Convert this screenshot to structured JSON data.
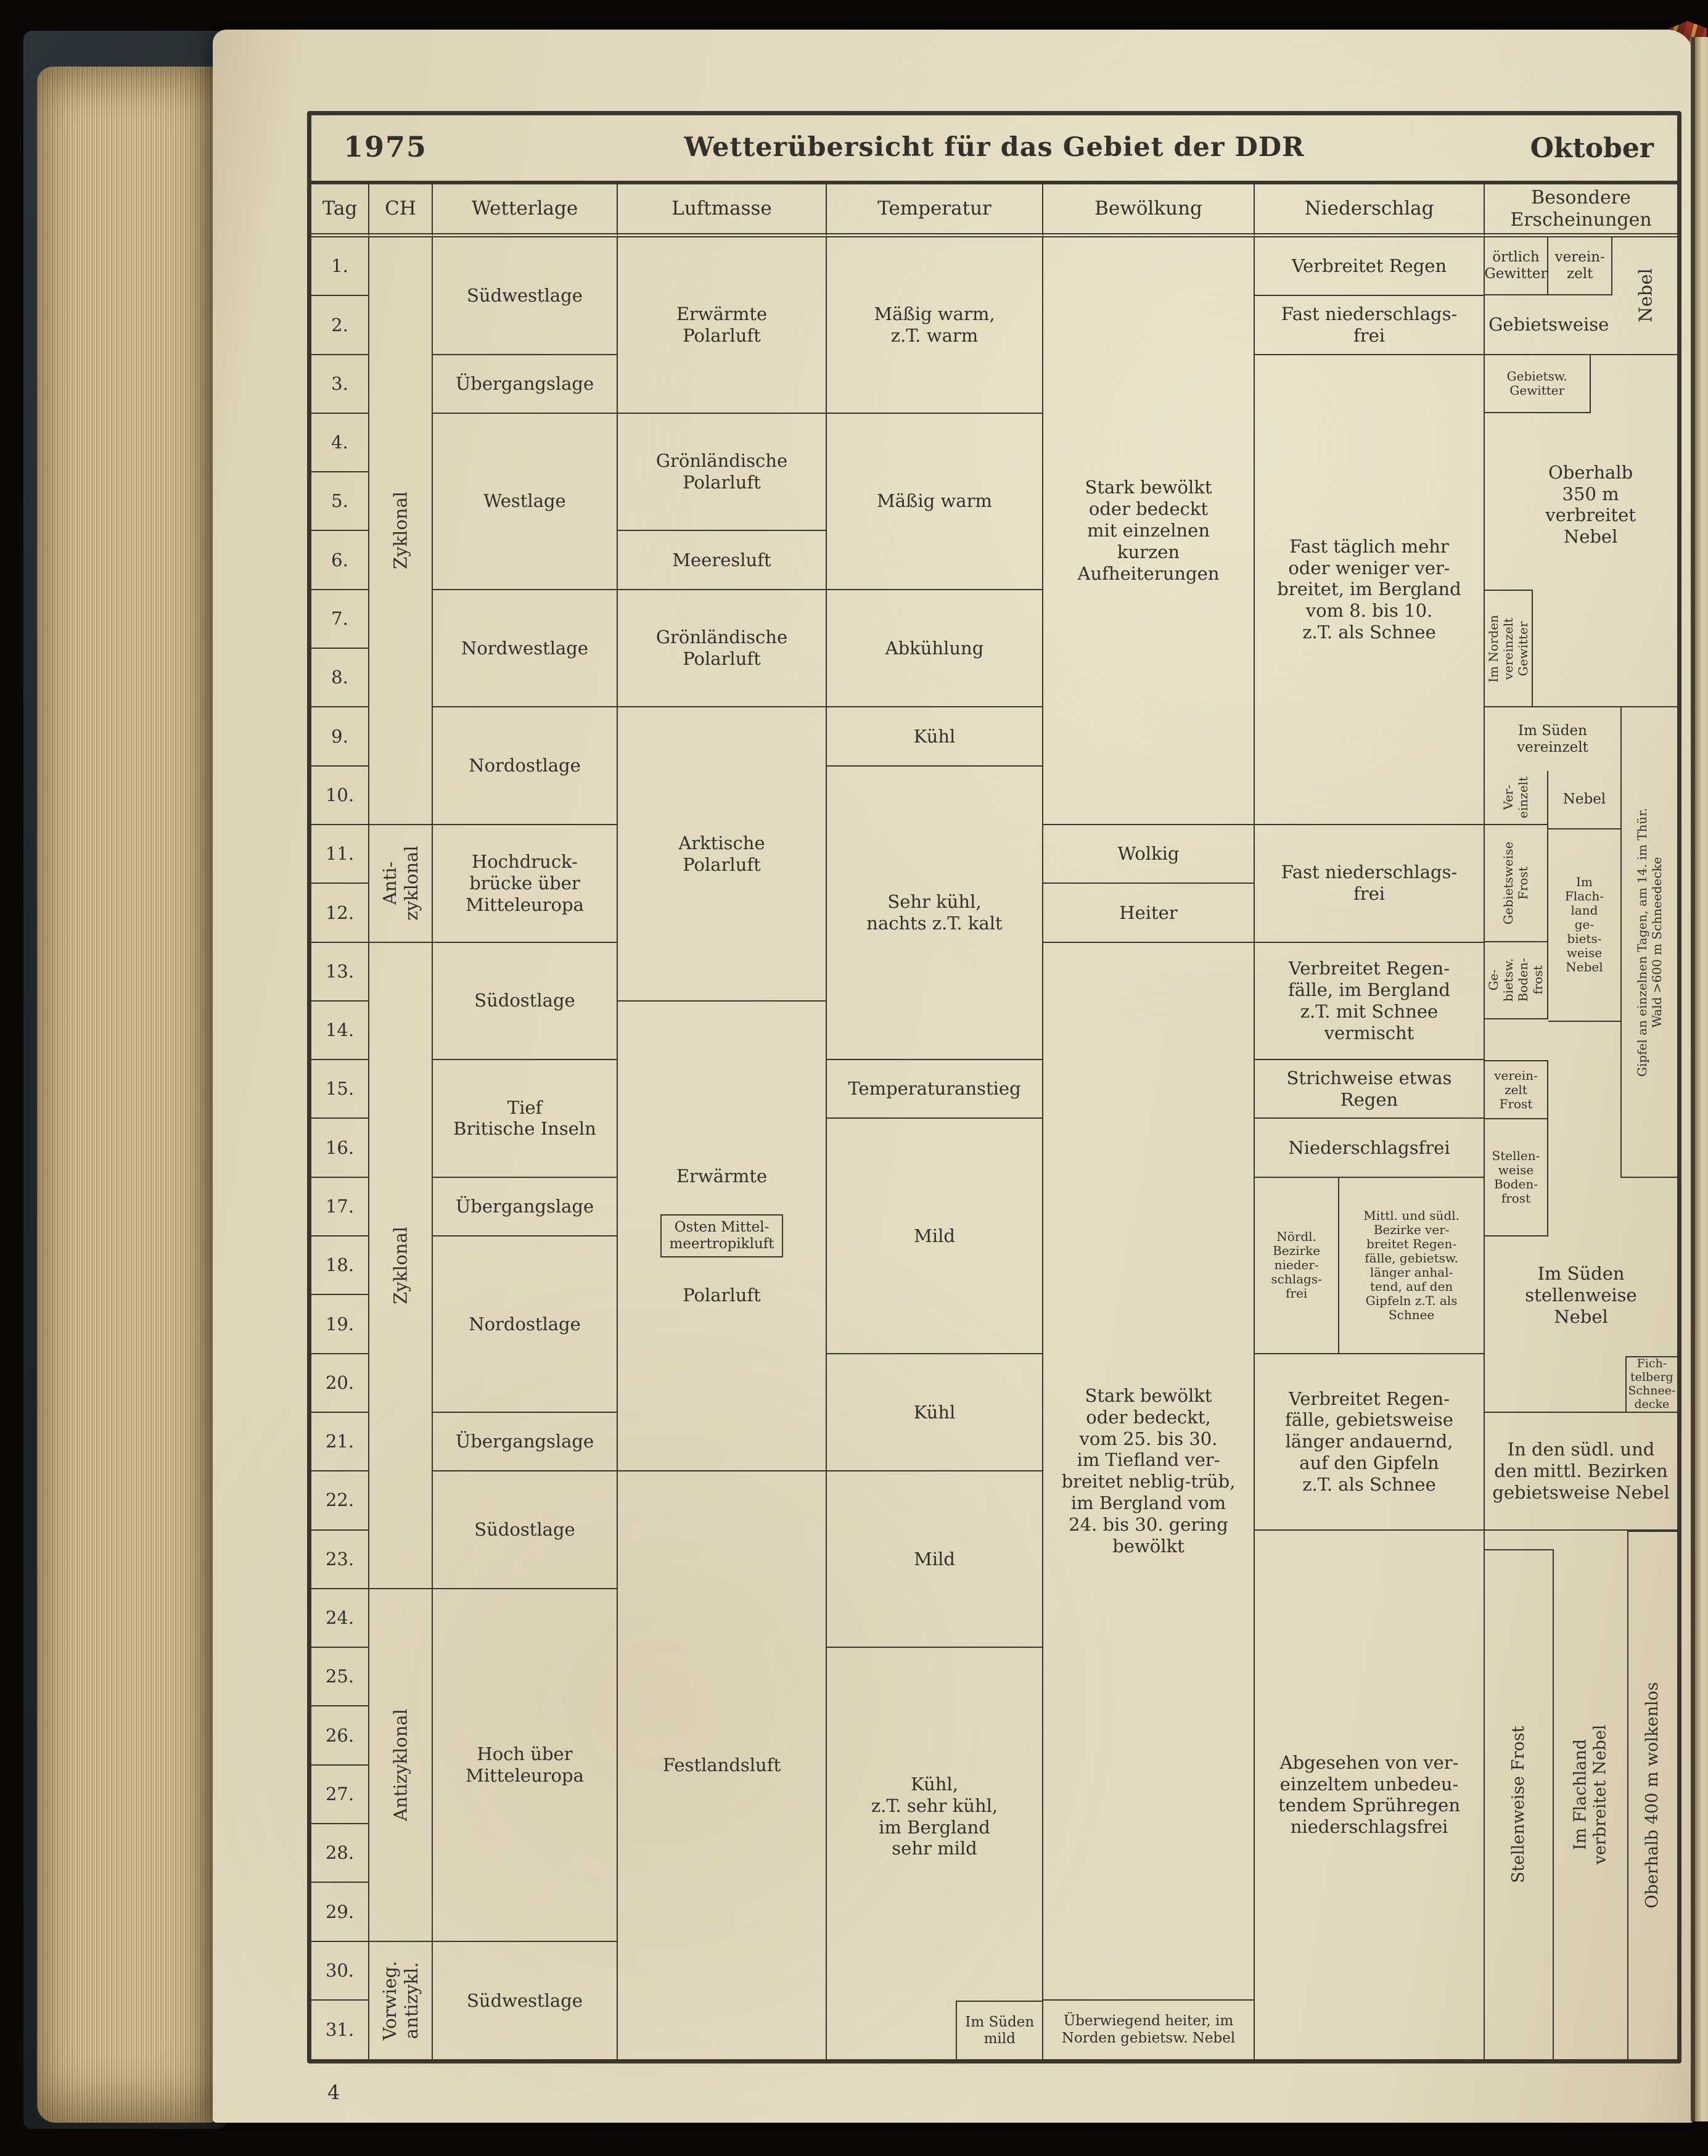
{
  "page": {
    "year": "1975",
    "title": "Wetterübersicht für das Gebiet der DDR",
    "month": "Oktober",
    "page_number": "4"
  },
  "header": {
    "tag": "Tag",
    "ch": "CH",
    "wetterlage": "Wetterlage",
    "luftmasse": "Luftmasse",
    "temperatur": "Temperatur",
    "bewoelkung": "Bewölkung",
    "niederschlag": "Niederschlag",
    "besondere": "Besondere\nErscheinungen"
  },
  "days": [
    "1.",
    "2.",
    "3.",
    "4.",
    "5.",
    "6.",
    "7.",
    "8.",
    "9.",
    "10.",
    "11.",
    "12.",
    "13.",
    "14.",
    "15.",
    "16.",
    "17.",
    "18.",
    "19.",
    "20.",
    "21.",
    "22.",
    "23.",
    "24.",
    "25.",
    "26.",
    "27.",
    "28.",
    "29.",
    "30.",
    "31."
  ],
  "ch": [
    {
      "rows": "1-10",
      "text": "Zyklonal"
    },
    {
      "rows": "11-12",
      "text": "Anti-\nzyklonal"
    },
    {
      "rows": "13-23",
      "text": "Zyklonal"
    },
    {
      "rows": "24-29",
      "text": "Antizyklonal"
    },
    {
      "rows": "30-31",
      "text": "Vorwieg.\nantizykl."
    }
  ],
  "wetterlage": [
    {
      "rows": "1-2",
      "text": "Südwestlage"
    },
    {
      "rows": "3",
      "text": "Übergangslage"
    },
    {
      "rows": "4-6",
      "text": "Westlage"
    },
    {
      "rows": "7-8",
      "text": "Nordwestlage"
    },
    {
      "rows": "9-10",
      "text": "Nordostlage"
    },
    {
      "rows": "11-12",
      "text": "Hochdruck-\nbrücke über\nMitteleuropa"
    },
    {
      "rows": "13-14",
      "text": "Südostlage"
    },
    {
      "rows": "15-16",
      "text": "Tief\nBritische Inseln"
    },
    {
      "rows": "17",
      "text": "Übergangslage"
    },
    {
      "rows": "18-20",
      "text": "Nordostlage"
    },
    {
      "rows": "21",
      "text": "Übergangslage"
    },
    {
      "rows": "22-23",
      "text": "Südostlage"
    },
    {
      "rows": "24-29",
      "text": "Hoch über\nMitteleuropa"
    },
    {
      "rows": "30-31",
      "text": "Südwestlage"
    }
  ],
  "luftmasse": [
    {
      "rows": "1-3",
      "text": "Erwärmte\nPolarluft"
    },
    {
      "rows": "4-5",
      "text": "Grönländische\nPolarluft"
    },
    {
      "rows": "6",
      "text": "Meeresluft"
    },
    {
      "rows": "7-8",
      "text": "Grönländische\nPolarluft"
    },
    {
      "rows": "9-13",
      "text": "Arktische\nPolarluft"
    },
    {
      "rows": "14-21",
      "text": "Erwärmte"
    },
    {
      "rows": "18",
      "text": "Osten Mittel-\nmeertropikluft"
    },
    {
      "rows": "14-21",
      "text": "Polarluft"
    },
    {
      "rows": "22-31",
      "text": "Festlandsluft"
    }
  ],
  "temperatur": [
    {
      "rows": "1-3",
      "text": "Mäßig warm,\nz.T. warm"
    },
    {
      "rows": "4-6",
      "text": "Mäßig warm"
    },
    {
      "rows": "7-8",
      "text": "Abkühlung"
    },
    {
      "rows": "9",
      "text": "Kühl"
    },
    {
      "rows": "10-14",
      "text": "Sehr kühl,\nnachts z.T. kalt"
    },
    {
      "rows": "15",
      "text": "Temperaturanstieg"
    },
    {
      "rows": "16-19",
      "text": "Mild"
    },
    {
      "rows": "20-21",
      "text": "Kühl"
    },
    {
      "rows": "22-24",
      "text": "Mild"
    },
    {
      "rows": "25-31",
      "text": "Kühl,\nz.T. sehr kühl,\nim Bergland\nsehr mild"
    },
    {
      "rows": "31",
      "text": "Im Süden\nmild"
    }
  ],
  "bewoelkung": [
    {
      "rows": "1-10",
      "text": "Stark bewölkt\noder bedeckt\nmit einzelnen\nkurzen\nAufheiterungen"
    },
    {
      "rows": "11",
      "text": "Wolkig"
    },
    {
      "rows": "12",
      "text": "Heiter"
    },
    {
      "rows": "13-30",
      "text": "Stark bewölkt\noder bedeckt,\nvom 25. bis 30.\nim Tiefland ver-\nbreitet neblig-trüb,\nim Bergland vom\n24. bis 30. gering\nbewölkt"
    },
    {
      "rows": "31",
      "text": "Überwiegend heiter, im\nNorden gebietsw. Nebel"
    }
  ],
  "niederschlag": [
    {
      "rows": "1",
      "text": "Verbreitet Regen"
    },
    {
      "rows": "2",
      "text": "Fast niederschlags-\nfrei"
    },
    {
      "rows": "3-10",
      "text": "Fast täglich mehr\noder weniger ver-\nbreitet, im Bergland\nvom 8. bis 10.\nz.T. als Schnee"
    },
    {
      "rows": "11-12",
      "text": "Fast niederschlags-\nfrei"
    },
    {
      "rows": "13-14",
      "text": "Verbreitet Regen-\nfälle, im Bergland\nz.T. mit Schnee\nvermischt"
    },
    {
      "rows": "15",
      "text": "Strichweise etwas\nRegen"
    },
    {
      "rows": "16",
      "text": "Niederschlagsfrei"
    },
    {
      "rows": "17-19",
      "text": "Nördl.\nBezirke\nnieder-\nschlags-\nfrei"
    },
    {
      "rows": "17-19",
      "text": "Mittl. und südl.\nBezirke ver-\nbreitet Regen-\nfälle, gebietsw.\nlänger anhal-\ntend, auf den\nGipfeln z.T. als\nSchnee"
    },
    {
      "rows": "20-22",
      "text": "Verbreitet Regen-\nfälle, gebietsweise\nlänger andauernd,\nauf den Gipfeln\nz.T. als Schnee"
    },
    {
      "rows": "23-31",
      "text": "Abgesehen von ver-\neinzeltem unbedeu-\ntendem Sprühregen\nniederschlagsfrei"
    }
  ],
  "besondere": [
    {
      "rows": "1",
      "text": "örtlich\nGewitter"
    },
    {
      "rows": "1",
      "text": "verein-\nzelt"
    },
    {
      "rows": "2",
      "text": "Gebietsweise"
    },
    {
      "rows": "1-2",
      "text": "Nebel",
      "rotated": true
    },
    {
      "rows": "3",
      "text": "Gebietsw.\nGewitter"
    },
    {
      "rows": "4-6",
      "text": "Oberhalb\n350 m\nverbreitet\nNebel"
    },
    {
      "rows": "7-8",
      "text": "Im Norden\nvereinzelt\nGewitter",
      "rotated": true
    },
    {
      "rows": "9",
      "text": "Im Süden\nvereinzelt"
    },
    {
      "rows": "10",
      "text": "Ver-\neinzelt",
      "rotated": true
    },
    {
      "rows": "11-12",
      "text": "Gebietsweise\nFrost",
      "rotated": true
    },
    {
      "rows": "13-14",
      "text": "Ge-\nbietsw.\nBoden-\nfrost",
      "rotated": true
    },
    {
      "rows": "10",
      "text": "Nebel"
    },
    {
      "rows": "11-14",
      "text": "Im\nFlach-\nland\nge-\nbiets-\nweise\nNebel"
    },
    {
      "rows": "9-16",
      "text": "Gipfel an einzelnen Tagen, am 14. im Thür.\nWald >600 m Schneedecke",
      "rotated": true
    },
    {
      "rows": "15",
      "text": "verein-\nzelt\nFrost"
    },
    {
      "rows": "16-17",
      "text": "Stellen-\nweise\nBoden-\nfrost"
    },
    {
      "rows": "18-19",
      "text": "Im Süden\nstellenweise\nNebel"
    },
    {
      "rows": "20",
      "text": "Fich-\ntelberg\nSchnee-\ndecke"
    },
    {
      "rows": "21-23",
      "text": "In den südl. und\nden mittl. Bezirken\ngebietsweise Nebel"
    },
    {
      "rows": "24-31",
      "text": "Stellenweise Frost",
      "rotated": true
    },
    {
      "rows": "24-31",
      "text": "Im Flachland\nverbreitet Nebel",
      "rotated": true
    },
    {
      "rows": "24-31",
      "text": "Oberhalb 400 m wolkenlos",
      "rotated": true
    }
  ],
  "colors": {
    "background": "#0b0806",
    "paper": "#e1d8bd",
    "table_line": "#3a362b",
    "ink": "#33302a",
    "cover": "#262b2e",
    "ribbon_red": "#a23527",
    "ribbon_gold": "#cf9a3e"
  }
}
